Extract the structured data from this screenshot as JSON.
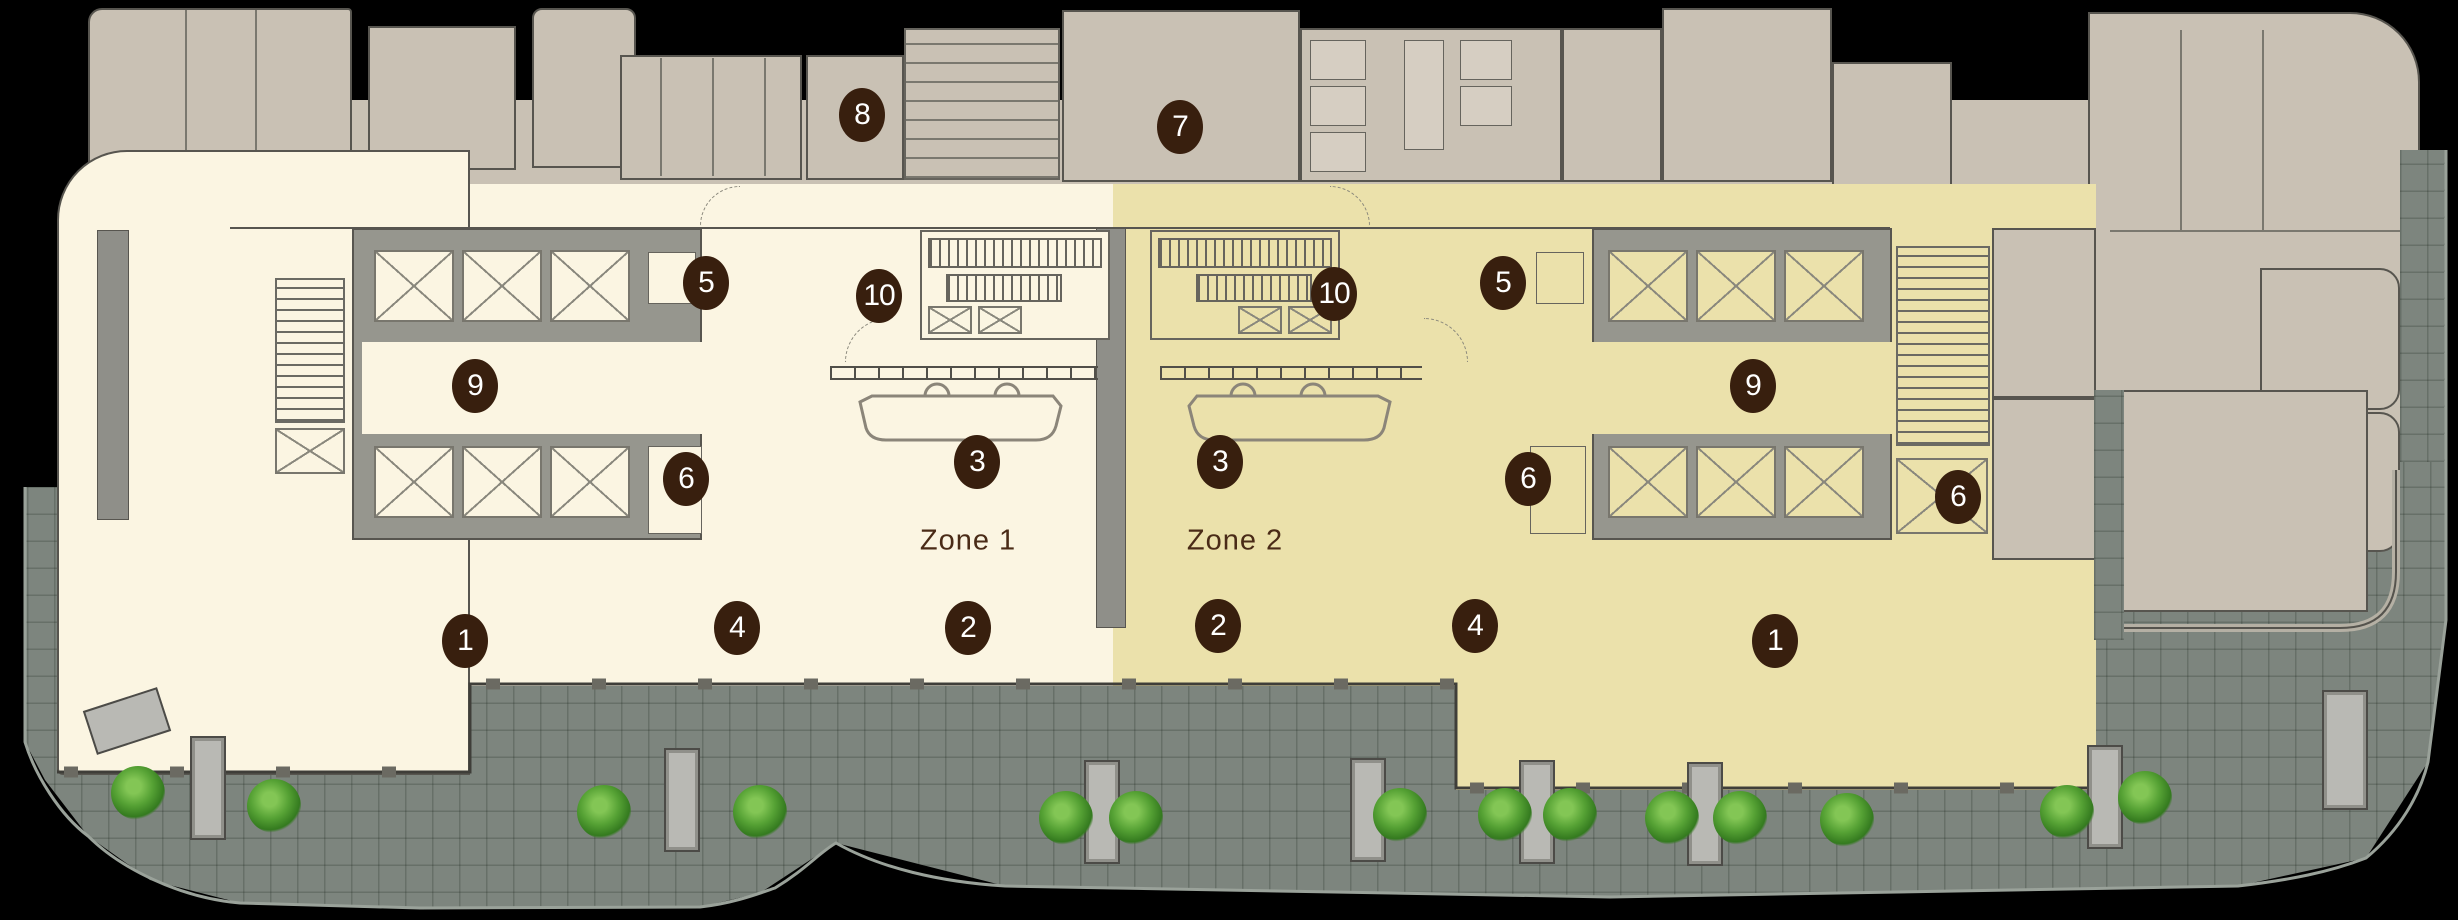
{
  "plan": {
    "name": "ground-floor-keyplan",
    "zones": [
      {
        "id": "zone-1",
        "label": "Zone 1",
        "fill": "#fbf5e2",
        "x": 968,
        "y": 541
      },
      {
        "id": "zone-2",
        "label": "Zone 2",
        "fill": "#ebe1ab",
        "x": 1235,
        "y": 541
      }
    ],
    "markers": [
      {
        "label": "8",
        "x": 862,
        "y": 115
      },
      {
        "label": "7",
        "x": 1180,
        "y": 127
      },
      {
        "label": "5",
        "x": 706,
        "y": 283
      },
      {
        "label": "10",
        "x": 879,
        "y": 296
      },
      {
        "label": "10",
        "x": 1334,
        "y": 294
      },
      {
        "label": "5",
        "x": 1503,
        "y": 283
      },
      {
        "label": "9",
        "x": 475,
        "y": 386
      },
      {
        "label": "9",
        "x": 1753,
        "y": 386
      },
      {
        "label": "6",
        "x": 686,
        "y": 479
      },
      {
        "label": "3",
        "x": 977,
        "y": 462
      },
      {
        "label": "3",
        "x": 1220,
        "y": 462
      },
      {
        "label": "6",
        "x": 1528,
        "y": 479
      },
      {
        "label": "6",
        "x": 1958,
        "y": 497
      },
      {
        "label": "1",
        "x": 465,
        "y": 641
      },
      {
        "label": "4",
        "x": 737,
        "y": 628
      },
      {
        "label": "2",
        "x": 968,
        "y": 628
      },
      {
        "label": "2",
        "x": 1218,
        "y": 626
      },
      {
        "label": "4",
        "x": 1475,
        "y": 626
      },
      {
        "label": "1",
        "x": 1775,
        "y": 641
      }
    ],
    "colors": {
      "background": "#000000",
      "back_of_house": "#c9c1b4",
      "zone1_fill": "#fbf5e2",
      "zone2_fill": "#ebe1ab",
      "core_wall": "#96968e",
      "wall_line": "#57554f",
      "terrace": "#7d857e",
      "marker": "#381f0e",
      "marker_text": "#ffffff",
      "zone_label_text": "#4a2b17",
      "shrub_green": "#55a134"
    },
    "features": [
      "elevator-bank",
      "escalators",
      "stairs",
      "turnstiles",
      "reception-desk",
      "restrooms",
      "storage-stalls",
      "terrace-paving",
      "planters",
      "shrubs"
    ]
  }
}
